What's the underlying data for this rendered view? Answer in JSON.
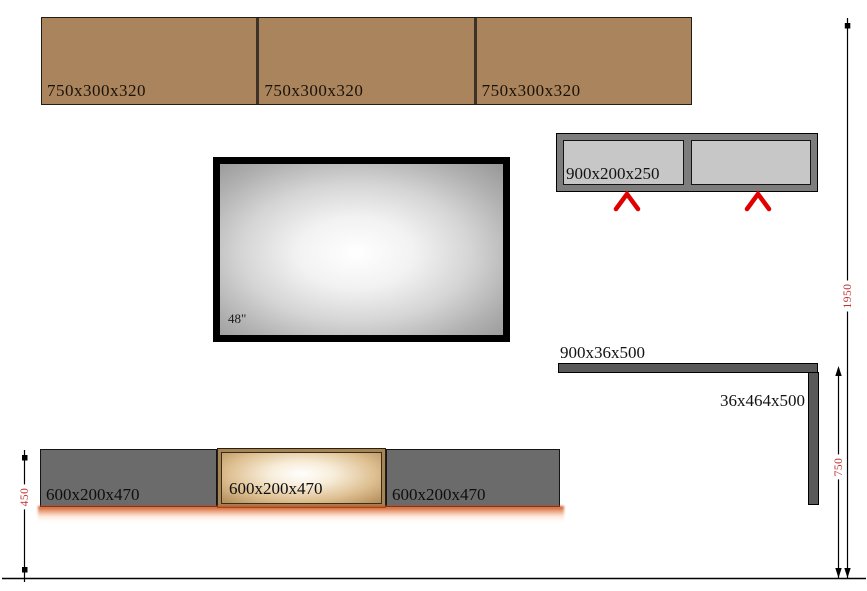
{
  "top_cabinets": {
    "items": [
      "750x300x320",
      "750x300x320",
      "750x300x320"
    ]
  },
  "tv": {
    "size_label": "48\""
  },
  "wall_shelf": {
    "label": "900x200x250"
  },
  "angle_shelf": {
    "top_label": "900x36x500",
    "side_label": "36x464x500"
  },
  "bottom_cabinets": {
    "items": [
      "600x200x470",
      "600x200x470",
      "600x200x470"
    ]
  },
  "dims": {
    "left_height": "450",
    "inner_height": "750",
    "total_height": "1950"
  },
  "colors": {
    "cabinet_brown": "#a9845c",
    "cabinet_gray": "#6b6b6b",
    "shelf_dark_gray": "#595959",
    "wall_shelf_frame": "#7d7d7d",
    "wall_shelf_panel": "#c7c7c7",
    "accent_red": "#e00000",
    "dimension_red": "#c03030",
    "glow_orange": "#c8461a"
  }
}
